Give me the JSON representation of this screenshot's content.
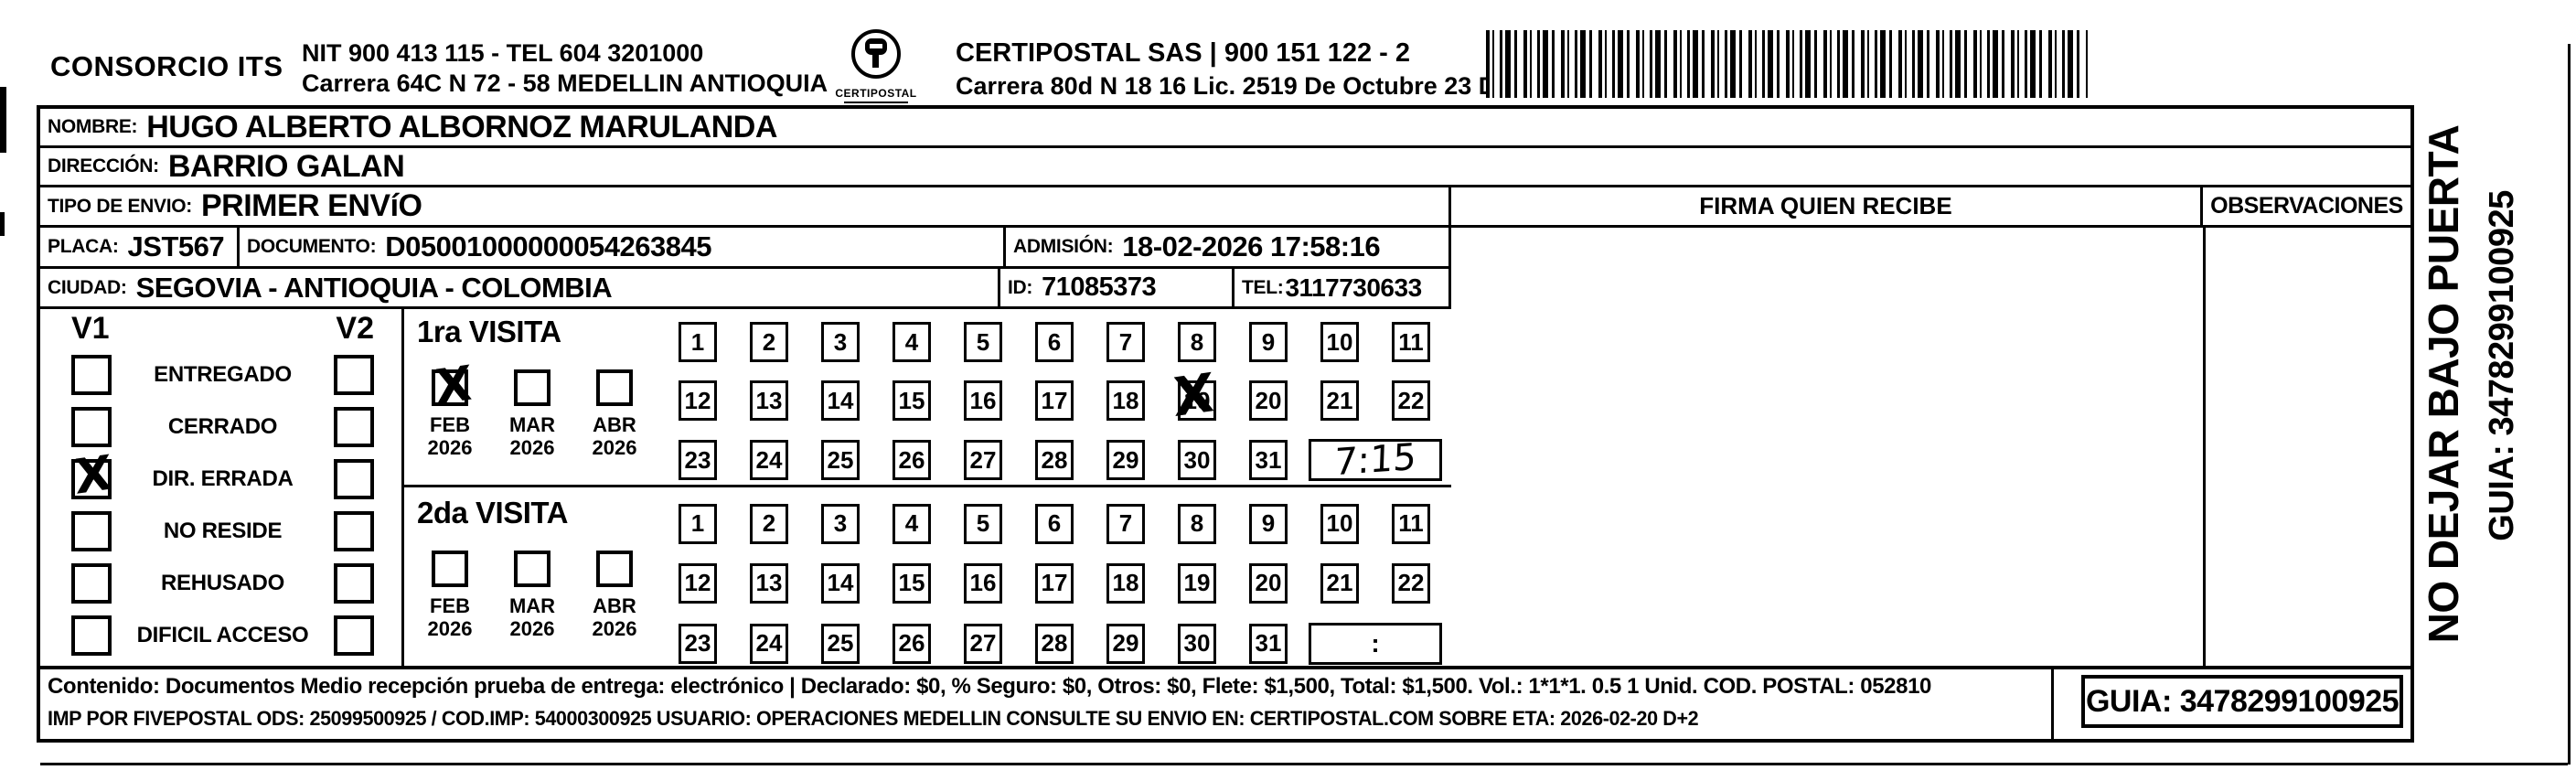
{
  "header": {
    "company": "CONSORCIO ITS",
    "nit_lines": [
      "NIT 900 413 115 - TEL 604 3201000",
      "Carrera 64C N 72 - 58 MEDELLIN ANTIOQUIA"
    ],
    "logo_text": "CERTIPOSTAL",
    "certipostal_lines": [
      "CERTIPOSTAL SAS | 900 151 122 - 2",
      "Carrera 80d N 18 16  Lic. 2519 De Octubre 23 De 2015"
    ]
  },
  "fields": {
    "nombre": {
      "label": "NOMBRE:",
      "value": "HUGO ALBERTO ALBORNOZ MARULANDA"
    },
    "direccion": {
      "label": "DIRECCIÓN:",
      "value": "BARRIO GALAN"
    },
    "tipo_envio": {
      "label": "TIPO DE ENVIO:",
      "value": "PRIMER ENVíO"
    },
    "placa": {
      "label": "PLACA:",
      "value": "JST567"
    },
    "documento": {
      "label": "DOCUMENTO:",
      "value": "D05001000000054263845"
    },
    "admision": {
      "label": "ADMISIÓN:",
      "value": "18-02-2026 17:58:16"
    },
    "ciudad": {
      "label": "CIUDAD:",
      "value": "SEGOVIA - ANTIOQUIA - COLOMBIA"
    },
    "id": {
      "label": "ID:",
      "value": "71085373"
    },
    "tel": {
      "label": "TEL:",
      "value": "3117730633"
    }
  },
  "status_panel": {
    "v1_header": "V1",
    "v2_header": "V2",
    "check_mark": "X",
    "items": [
      {
        "label": "ENTREGADO",
        "v1": false,
        "v2": false
      },
      {
        "label": "CERRADO",
        "v1": false,
        "v2": false
      },
      {
        "label": "DIR. ERRADA",
        "v1": true,
        "v2": false
      },
      {
        "label": "NO RESIDE",
        "v1": false,
        "v2": false
      },
      {
        "label": "REHUSADO",
        "v1": false,
        "v2": false
      },
      {
        "label": "DIFICIL ACCESO",
        "v1": false,
        "v2": false
      }
    ]
  },
  "day_numbers": [
    1,
    2,
    3,
    4,
    5,
    6,
    7,
    8,
    9,
    10,
    11,
    12,
    13,
    14,
    15,
    16,
    17,
    18,
    19,
    20,
    21,
    22,
    23,
    24,
    25,
    26,
    27,
    28,
    29,
    30,
    31
  ],
  "visits": [
    {
      "title": "1ra VISITA",
      "months": [
        {
          "month": "FEB",
          "year": "2026",
          "checked": true
        },
        {
          "month": "MAR",
          "year": "2026",
          "checked": false
        },
        {
          "month": "ABR",
          "year": "2026",
          "checked": false
        }
      ],
      "days_crossed": [
        19
      ],
      "time": "7:15",
      "time_handwritten": true
    },
    {
      "title": "2da VISITA",
      "months": [
        {
          "month": "FEB",
          "year": "2026",
          "checked": false
        },
        {
          "month": "MAR",
          "year": "2026",
          "checked": false
        },
        {
          "month": "ABR",
          "year": "2026",
          "checked": false
        }
      ],
      "days_crossed": [],
      "time": ":",
      "time_handwritten": false
    }
  ],
  "delivery": {
    "firma_header": "FIRMA QUIEN RECIBE",
    "observaciones_header": "OBSERVACIONES"
  },
  "side_text": {
    "warning": "NO DEJAR BAJO PUERTA",
    "guia": "GUIA: 3478299100925"
  },
  "footer": {
    "line1": "Contenido: Documentos Medio recepción prueba de entrega: electrónico | Declarado: $0, % Seguro: $0, Otros: $0, Flete: $1,500, Total: $1,500. Vol.: 1*1*1. 0.5  1 Unid. COD. POSTAL: 052810",
    "line2": "IMP POR FIVEPOSTAL ODS: 25099500925 / COD.IMP: 54000300925 USUARIO: OPERACIONES MEDELLIN CONSULTE SU ENVIO EN: CERTIPOSTAL.COM SOBRE ETA: 2026-02-20 D+2",
    "guia_box": "GUIA: 3478299100925"
  },
  "icons": {
    "barcode": "code128-barcode-stripes",
    "logo": "certipostal-circular-seal"
  }
}
